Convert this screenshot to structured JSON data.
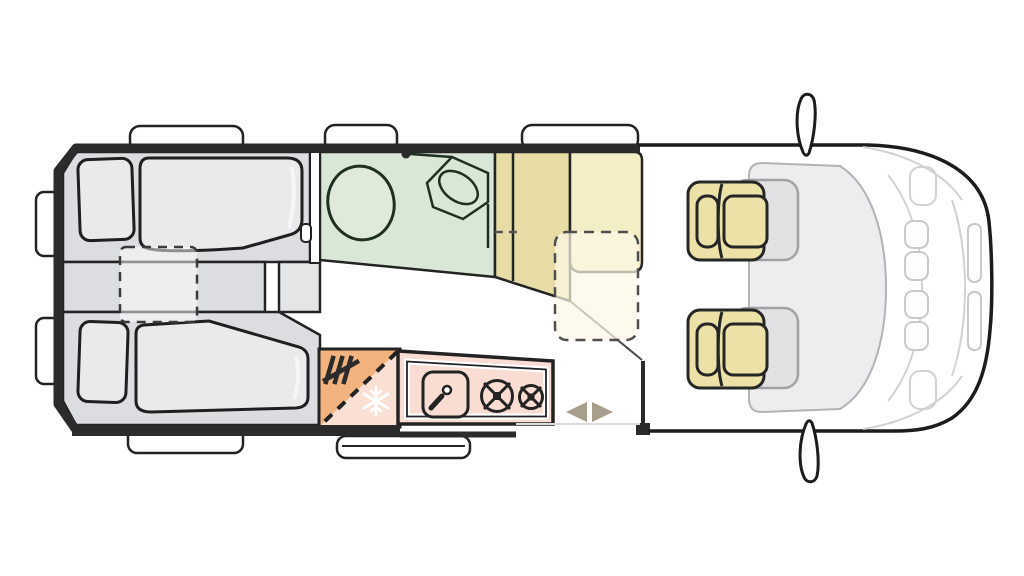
{
  "diagram": {
    "type": "campervan-floor-plan",
    "view": "top-down",
    "vehicle_front": "right",
    "zones": [
      {
        "id": "rear-bedroom",
        "name": "twin-single-beds-with-filler-cushion"
      },
      {
        "id": "bathroom",
        "name": "washroom-toilet-and-corner-basin"
      },
      {
        "id": "wardrobe",
        "name": "wardrobe-cabinet"
      },
      {
        "id": "kitchen",
        "name": "kitchenette-sink-and-two-burners"
      },
      {
        "id": "fridge",
        "name": "fridge-freezer-heater-column"
      },
      {
        "id": "entry",
        "name": "sliding-door-entry"
      },
      {
        "id": "cab",
        "name": "driver-cab-two-swivel-seats"
      }
    ],
    "icons": [
      "shower-head-icon",
      "heater-icon",
      "snowflake-icon",
      "faucet-icon",
      "burner-large-icon",
      "burner-small-icon",
      "arrow-left-icon",
      "arrow-right-icon",
      "side-mirror-icon"
    ]
  },
  "colors": {
    "wall": "#2b2b2b",
    "outline": "#232323",
    "floor": "#ffffff",
    "white": "#ffffff",
    "bed_base": "#dcdde0",
    "bed_strip": "#e4e5e7",
    "bed_linen": "#e9eaec",
    "linen_highlight": "#f6f6f8",
    "filler_fill": "rgba(255,255,255,0.5)",
    "bathroom": "#d9e8d6",
    "fixture": "#dfeadb",
    "wardrobe_dark": "#e8dca6",
    "wardrobe_light": "#f4eec7",
    "table_fill": "rgba(252,248,230,0.72)",
    "seat": "#ece2a8",
    "seat_ghost": "rgba(215,215,219,0.5)",
    "ghost_stroke": "#a2a2a4",
    "kitchen": "#f9dcd2",
    "fridge_orange": "#f2b37e",
    "fridge_pink": "#fadfd5",
    "snowflake": "#ffffff",
    "arrow": "#a79e8c",
    "glass": "#ededef",
    "glass_stroke": "#b3b3b5",
    "cab_line": "#d2d2d4",
    "headlight": "#c9c9cb",
    "floor_line": "#4a4a4a",
    "sill_line": "#dcdcdc"
  }
}
